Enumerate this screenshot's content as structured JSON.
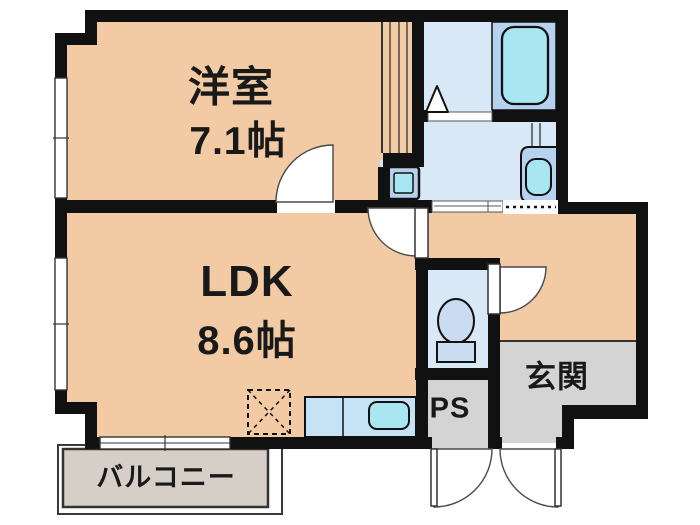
{
  "floorplan": {
    "rooms": {
      "western_room": {
        "label": "洋室",
        "size": "7.1帖"
      },
      "ldk": {
        "label": "LDK",
        "size": "8.6帖"
      },
      "balcony": {
        "label": "バルコニー"
      },
      "entrance": {
        "label": "玄関"
      },
      "pipe_space": {
        "label": "PS"
      }
    },
    "fixtures": [
      "bathtub",
      "wash-basin",
      "washing-machine-pan",
      "toilet",
      "kitchen-counter",
      "kitchen-sink",
      "refrigerator-space"
    ]
  },
  "colors": {
    "wall": "#111111",
    "peach": "#F2CBA4",
    "blue": "#D9E8F7",
    "panel": "#B7D2EE",
    "cyan": "#A8E7F2",
    "toiletfix": "#C9DCF2",
    "counter": "#C5E3F4",
    "gray": "#D4D4D4",
    "balcony": "#D6CFC8"
  }
}
